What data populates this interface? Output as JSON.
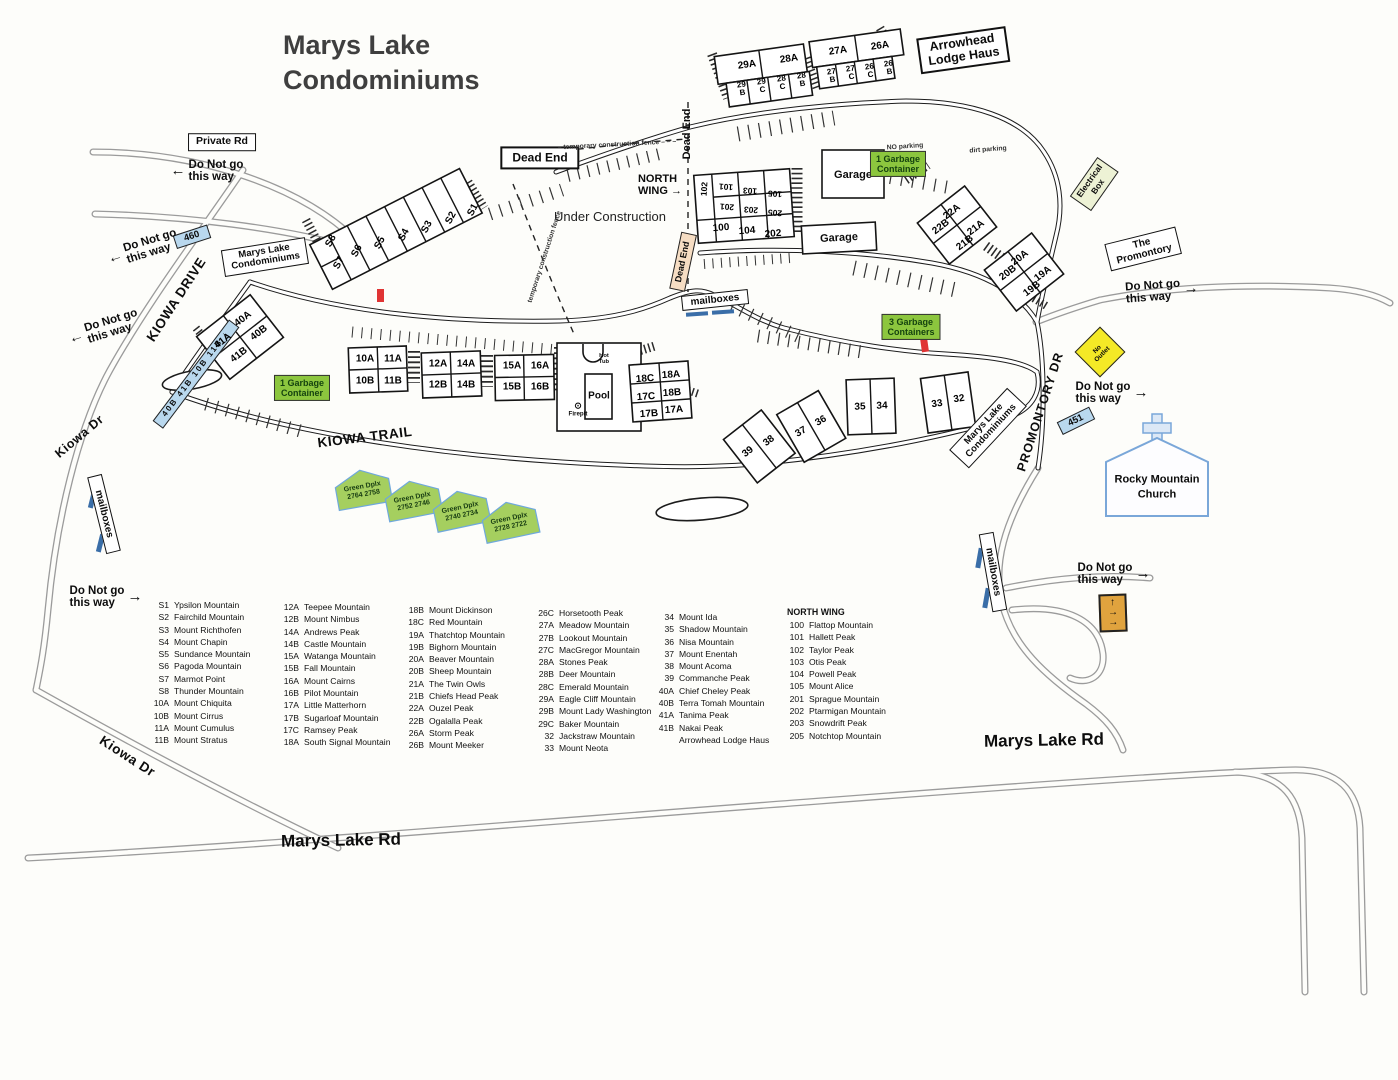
{
  "title": {
    "line1": "Marys Lake",
    "line2": "Condominiums"
  },
  "arrows": {
    "left": "←",
    "right": "→",
    "down": "↓",
    "up": "↑"
  },
  "colors": {
    "blue_sign": "#b9d8ee",
    "green_sign": "#8cc63e",
    "green_text": "#15430f",
    "yellow_sign": "#f4e926",
    "peach_sign": "#f6ddc3",
    "pale_sign": "#edf2d5",
    "orange_sign": "#e0a33e",
    "red_marker": "#e03434",
    "church_blue": "#7aa7d9",
    "ink": "#1c1c1c",
    "pencil": "#9b9b9b"
  },
  "signs": {
    "private_rd": "Private Rd",
    "dead_end": "Dead End",
    "arrowhead_l1": "Arrowhead",
    "arrowhead_l2": "Lodge Haus",
    "condos_l1": "Marys Lake",
    "condos_l2": "Condominiums",
    "promontory_l1": "The",
    "promontory_l2": "Promontory",
    "mailboxes": "mailboxes",
    "garage": "Garage",
    "garbage_1_l1": "1 Garbage",
    "garbage_1_l2": "Container",
    "garbage_3_l1": "3 Garbage",
    "garbage_3_l2": "Containers",
    "electrical_l1": "Electrical",
    "electrical_l2": "Box",
    "no_outlet_l1": "No",
    "no_outlet_l2": "Outlet",
    "route_460": "460",
    "route_451": "451",
    "street_units": "40B 41B 10B 11B",
    "church_l1": "Rocky Mountain",
    "church_l2": "Church",
    "pool": "Pool",
    "hot_tub_l1": "Hot",
    "hot_tub_l2": "Tub",
    "firepit": "Firepit",
    "firepit_icon": "⊙"
  },
  "labels": {
    "under_construction": "Under Construction",
    "north_wing_l1": "NORTH",
    "north_wing_l2": "WING",
    "temp_fence_h": "– temporary construction fence – – –",
    "temp_fence_d": "temporary construction fence",
    "no_parking": "NO parking",
    "dirt_parking": "dirt parking",
    "dng_l1": "Do Not go",
    "dng_l2": "this way"
  },
  "roads": {
    "kiowa_drive": "KIOWA DRIVE",
    "kiowa_dr": "Kiowa Dr",
    "kiowa_trail": "KIOWA TRAIL",
    "promontory_dr": "PROMONTORY DR",
    "marys_lake_rd": "Marys Lake Rd"
  },
  "green_duplex": {
    "name": "Green Dplx",
    "numbers": [
      "2764 2758",
      "2752 2746",
      "2740 2734",
      "2728 2722"
    ]
  },
  "units": {
    "s1": "S1",
    "s2": "S2",
    "s3": "S3",
    "s4": "S4",
    "s5": "S5",
    "s6": "S6",
    "s7": "S7",
    "s8": "S8",
    "a29": "29A",
    "a28": "28A",
    "b29": "29 B",
    "c29": "29 C",
    "c28": "28 C",
    "b28": "28 B",
    "a27": "27A",
    "a26": "26A",
    "b27": "27 B",
    "c27": "27 C",
    "c26": "26 C",
    "b26": "26 B",
    "a40": "40A",
    "b40": "40B",
    "a41": "41A",
    "b41": "41B",
    "a10": "10A",
    "b10": "10B",
    "a11": "11A",
    "b11": "11B",
    "a12": "12A",
    "b12": "12B",
    "a14": "14A",
    "b14": "14B",
    "a15": "15A",
    "b15": "15B",
    "a16": "16A",
    "b16": "16B",
    "c18": "18C",
    "a18": "18A",
    "c17": "17C",
    "b18": "18B",
    "b17": "17B",
    "a17": "17A",
    "u39": "39",
    "u38": "38",
    "u37": "37",
    "u36": "36",
    "u35": "35",
    "u34": "34",
    "u33": "33",
    "u32": "32",
    "a22": "22A",
    "a21": "21A",
    "b22": "22B",
    "b21": "21B",
    "a20": "20A",
    "a19": "19A",
    "b20": "20B",
    "b19": "19B",
    "n102": "102",
    "n101": "101",
    "n103": "103",
    "n105": "105",
    "n201": "201",
    "n203": "203",
    "n205": "205",
    "n100": "100",
    "n104": "104",
    "n202": "202"
  },
  "legend": {
    "columns": [
      [
        {
          "code": "S1",
          "name": "Ypsilon Mountain"
        },
        {
          "code": "S2",
          "name": "Fairchild Mountain"
        },
        {
          "code": "S3",
          "name": "Mount Richthofen"
        },
        {
          "code": "S4",
          "name": "Mount Chapin"
        },
        {
          "code": "S5",
          "name": "Sundance Mountain"
        },
        {
          "code": "S6",
          "name": "Pagoda Mountain"
        },
        {
          "code": "S7",
          "name": "Marmot Point"
        },
        {
          "code": "S8",
          "name": "Thunder Mountain"
        },
        {
          "code": "10A",
          "name": "Mount Chiquita"
        },
        {
          "code": "10B",
          "name": "Mount Cirrus"
        },
        {
          "code": "11A",
          "name": "Mount Cumulus"
        },
        {
          "code": "11B",
          "name": "Mount Stratus"
        }
      ],
      [
        {
          "code": "12A",
          "name": "Teepee Mountain"
        },
        {
          "code": "12B",
          "name": "Mount Nimbus"
        },
        {
          "code": "14A",
          "name": "Andrews Peak"
        },
        {
          "code": "14B",
          "name": "Castle Mountain"
        },
        {
          "code": "15A",
          "name": "Watanga Mountain"
        },
        {
          "code": "15B",
          "name": "Fall Mountain"
        },
        {
          "code": "16A",
          "name": "Mount Cairns"
        },
        {
          "code": "16B",
          "name": "Pilot Mountain"
        },
        {
          "code": "17A",
          "name": "Little Matterhorn"
        },
        {
          "code": "17B",
          "name": "Sugarloaf Mountain"
        },
        {
          "code": "17C",
          "name": "Ramsey Peak"
        },
        {
          "code": "18A",
          "name": "South Signal Mountain"
        }
      ],
      [
        {
          "code": "18B",
          "name": "Mount Dickinson"
        },
        {
          "code": "18C",
          "name": "Red Mountain"
        },
        {
          "code": "19A",
          "name": "Thatchtop Mountain"
        },
        {
          "code": "19B",
          "name": "Bighorn Mountain"
        },
        {
          "code": "20A",
          "name": "Beaver Mountain"
        },
        {
          "code": "20B",
          "name": "Sheep Mountain"
        },
        {
          "code": "21A",
          "name": "The Twin Owls"
        },
        {
          "code": "21B",
          "name": "Chiefs Head Peak"
        },
        {
          "code": "22A",
          "name": "Ouzel Peak"
        },
        {
          "code": "22B",
          "name": "Ogalalla Peak"
        },
        {
          "code": "26A",
          "name": "Storm Peak"
        },
        {
          "code": "26B",
          "name": "Mount Meeker"
        }
      ],
      [
        {
          "code": "26C",
          "name": "Horsetooth Peak"
        },
        {
          "code": "27A",
          "name": "Meadow Mountain"
        },
        {
          "code": "27B",
          "name": "Lookout Mountain"
        },
        {
          "code": "27C",
          "name": "MacGregor Mountain"
        },
        {
          "code": "28A",
          "name": "Stones Peak"
        },
        {
          "code": "28B",
          "name": "Deer Mountain"
        },
        {
          "code": "28C",
          "name": "Emerald Mountain"
        },
        {
          "code": "29A",
          "name": "Eagle Cliff Mountain"
        },
        {
          "code": "29B",
          "name": "Mount Lady Washington"
        },
        {
          "code": "29C",
          "name": "Baker Mountain"
        },
        {
          "code": "32",
          "name": "Jackstraw Mountain"
        },
        {
          "code": "33",
          "name": "Mount Neota"
        }
      ],
      [
        {
          "code": "34",
          "name": "Mount Ida"
        },
        {
          "code": "35",
          "name": "Shadow Mountain"
        },
        {
          "code": "36",
          "name": "Nisa Mountain"
        },
        {
          "code": "37",
          "name": "Mount Enentah"
        },
        {
          "code": "38",
          "name": "Mount Acoma"
        },
        {
          "code": "39",
          "name": "Commanche Peak"
        },
        {
          "code": "40A",
          "name": "Chief Cheley Peak"
        },
        {
          "code": "40B",
          "name": "Terra Tomah Mountain"
        },
        {
          "code": "41A",
          "name": "Tanima Peak"
        },
        {
          "code": "41B",
          "name": "Nakai Peak"
        },
        {
          "code": "",
          "name": "Arrowhead Lodge Haus"
        }
      ]
    ],
    "north_wing_header": "NORTH WING",
    "north_wing_entries": [
      {
        "code": "100",
        "name": "Flattop Mountain"
      },
      {
        "code": "101",
        "name": "Hallett Peak"
      },
      {
        "code": "102",
        "name": "Taylor Peak"
      },
      {
        "code": "103",
        "name": "Otis Peak"
      },
      {
        "code": "104",
        "name": "Powell Peak"
      },
      {
        "code": "105",
        "name": "Mount Alice"
      },
      {
        "code": "201",
        "name": "Sprague Mountain"
      },
      {
        "code": "202",
        "name": "Ptarmigan Mountain"
      },
      {
        "code": "203",
        "name": "Snowdrift Peak"
      },
      {
        "code": "205",
        "name": "Notchtop Mountain"
      }
    ]
  }
}
